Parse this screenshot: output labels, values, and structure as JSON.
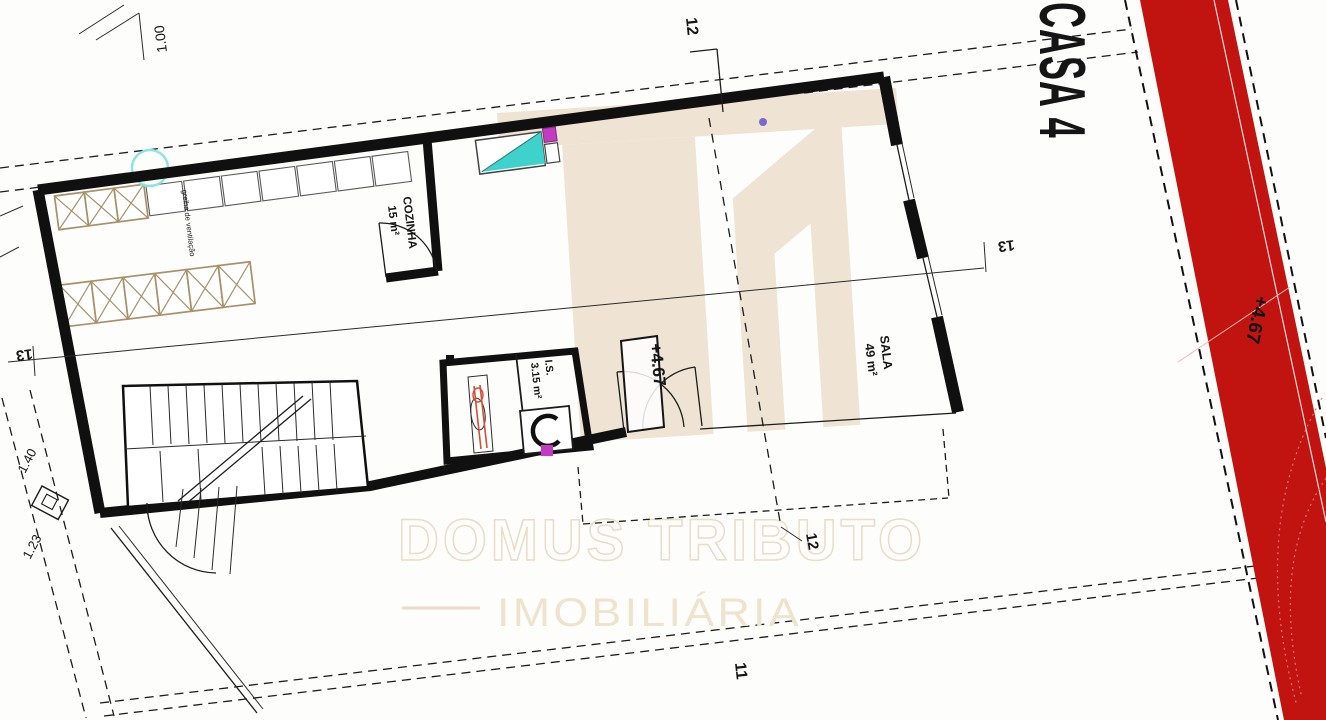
{
  "plan": {
    "casa_label": "CASA 4",
    "rooms": {
      "kitchen": {
        "name": "COZINHA",
        "area": "15 m²"
      },
      "living": {
        "name": "SALA",
        "area": "49 m²"
      },
      "bathroom": {
        "name": "I.S.",
        "area": "3.15 m²"
      }
    },
    "levels": {
      "interior": "+4.67",
      "exterior": "+4.67"
    },
    "section_marks": {
      "top": "12",
      "bottom": "12",
      "left": "13",
      "right": "13",
      "lower": "11"
    },
    "dimensions": {
      "top_left": "1.00",
      "left_upper": "1.40",
      "left_lower": "1.23"
    },
    "annotations": {
      "ventilation": "grelha de ventilação"
    }
  },
  "watermark": {
    "brand": "DOMUS TRIBUTO",
    "subtitle": "IMOBILIÁRIA"
  },
  "colors": {
    "red": "#c11310",
    "beige": "#efe4d3",
    "beige_text": "#f0e3cd",
    "beige_outline": "#eadcc6",
    "cyan": "#3fd2cc",
    "cyan_light": "#8fe3de",
    "magenta": "#c23bc0",
    "tan": "#a8906a",
    "ink": "#101010",
    "purple": "#7b68c8",
    "orange_red": "#d05038"
  }
}
